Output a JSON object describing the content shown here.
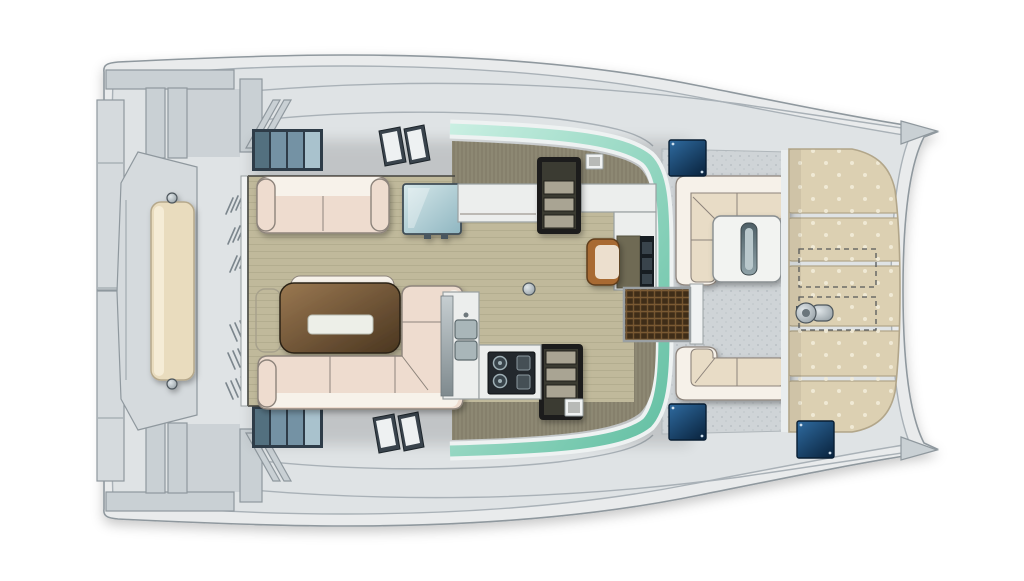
{
  "meta": {
    "type": "catamaran-deck-plan",
    "view": "top-down",
    "canvas": {
      "width": 1024,
      "height": 581
    }
  },
  "colors": {
    "bg": "#ffffff",
    "hull_fill": "#e9ebec",
    "hull_stroke": "#8f989e",
    "deck_fill": "#dfe3e5",
    "deck_line": "#a9b1b7",
    "platform_fill": "#d5dadd",
    "recess_fill": "#ccd2d6",
    "structure_fill": "#c9d0d4",
    "structure_stroke": "#8f989e",
    "bench_fill": "#e9dcbe",
    "bench_stroke": "#b5a88b",
    "bench_highlight": "#f5ecd6",
    "window_frame": "#2e3c48",
    "window_pane": "#7492a4",
    "window_pane_light": "#a9c2cd",
    "skylight_frame": "#39434c",
    "skylight_pane": "#eef1f2",
    "glass_teal": "#62bfa2",
    "glass_teal_light": "#c9efe2",
    "glass_frame": "#eef2f2",
    "olive": "#8d8873",
    "olive_dark": "#6b6653",
    "wood": "#c0b99b",
    "wood_line": "#a39c80",
    "wall_line": "#4a4a44",
    "sofa_cream": "#eedccf",
    "sofa_white": "#f7f2ea",
    "sofa_stroke": "#8d847b",
    "cushion_cream": "#e8dcc6",
    "cushion_white": "#f6f1e9",
    "table_brown_light": "#9a7851",
    "table_brown_dark": "#4a3620",
    "table_stroke": "#2c2112",
    "table_inset": "#edefe8",
    "counter_fill": "#eceeed",
    "counter_stroke": "#99a0a1",
    "appliance_dark": "#171d22",
    "stove_fill": "#23282d",
    "stairs_frame": "#1f1f1b",
    "stairs_well": "#3a3a33",
    "stairs_step": "#a9a493",
    "grate_fill": "#3f2d18",
    "grate_line": "#7a5a33",
    "door_fill": "#f0f2f2",
    "hatch_blue_light": "#2f6ba0",
    "hatch_blue_dark": "#0c2844",
    "hatch_stroke": "#091e33",
    "cockpit_floor": "#cfd4d7",
    "cockpit_speckle": "#b4bbc0",
    "cockpit_table": "#f2f3f1",
    "slot_dark": "#4e5f66",
    "slot_light": "#b9c8cc",
    "sunpad_fill": "#dcd0b2",
    "sunpad_stroke": "#b2a68a",
    "sunpad_dot": "#f2ecd9",
    "winch_metal_light": "#dfe5e8",
    "winch_metal_dark": "#8b969c",
    "dashed": "#55585a",
    "chair_brown": "#a86b33",
    "chair_inner": "#ecdfce",
    "glass_cabinet_1": "#d6e8ea",
    "glass_cabinet_2": "#8fb6c1",
    "sink_fill": "#a9b6b9"
  },
  "parts": {
    "hull": "catamaran hull and side decks",
    "stern-platform": "aft platform between hulls",
    "aft-bench": "aft bench cushion",
    "davit-structure": "aft crossbeams and davit pillars",
    "hull-window": "hull side window strip",
    "deck-skylight": "deck skylight hatch pair",
    "windshield": "wrap-around tinted glass",
    "salon": "main salon with wood floor",
    "salon-sofa": "salon sofa",
    "dinette-table": "dining table with tray inset",
    "glass-cabinet": "glass-top cabinet",
    "galley-counter": "galley counter with sinks",
    "cooktop": "galley cooktop",
    "companionway-stairs": "stairs down to hull cabins",
    "nav-desk": "chart desk with chair",
    "doormat-grate": "teak entry grate",
    "cockpit": "forward cockpit",
    "cockpit-seating": "C-shaped cockpit seating",
    "cockpit-table": "cockpit table",
    "foredeck-sunpads": "bow sunpad cushions",
    "winch": "deck winch",
    "deck-hatch": "flush deck hatch (dark blue)",
    "bow-tip": "bow point"
  }
}
